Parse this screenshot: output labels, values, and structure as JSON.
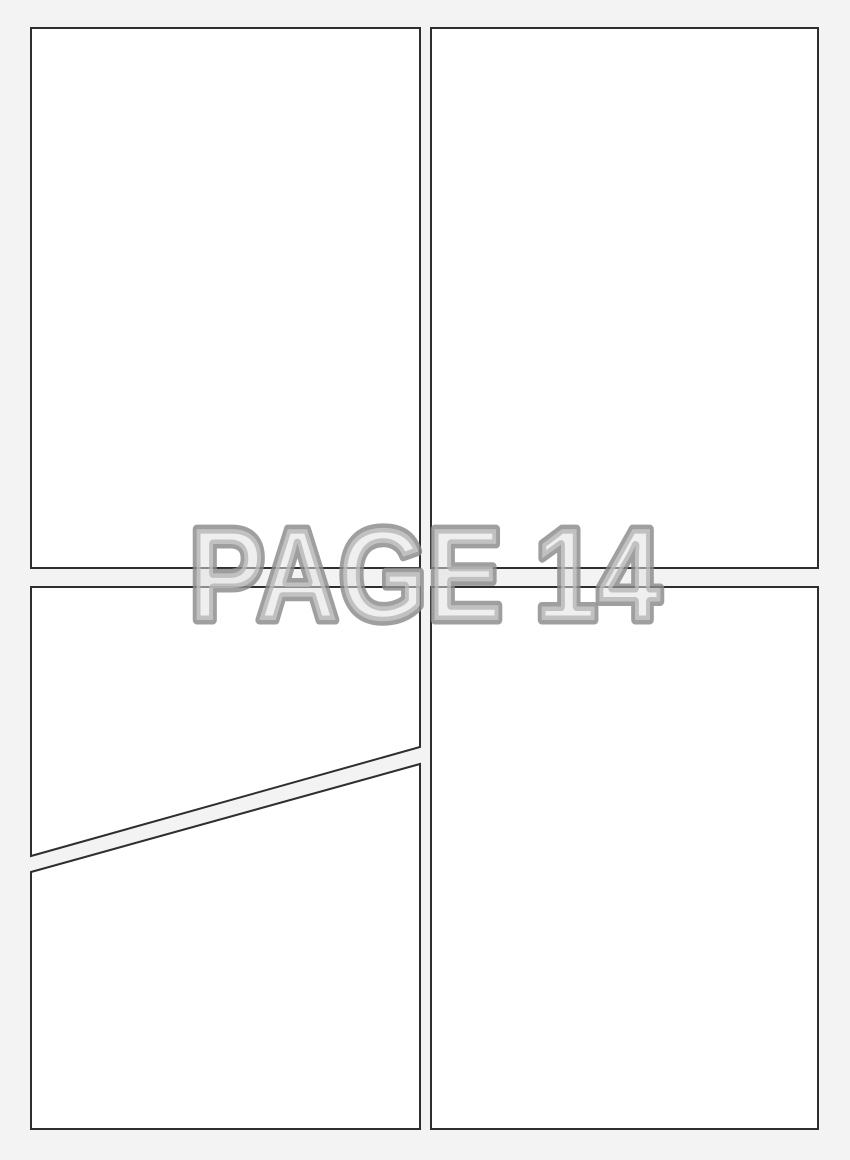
{
  "page": {
    "watermark": "PAGE 14",
    "colors": {
      "background": "#f3f3f3",
      "panel_fill": "#ffffff",
      "panel_border": "#2e2e2e",
      "watermark_fill": "#e0e0e0",
      "watermark_outline": "#8a8a8a"
    },
    "panels": [
      {
        "id": "panel-top-left"
      },
      {
        "id": "panel-top-right"
      },
      {
        "id": "panel-bottom-left-upper"
      },
      {
        "id": "panel-bottom-left-lower"
      },
      {
        "id": "panel-bottom-right"
      }
    ]
  }
}
